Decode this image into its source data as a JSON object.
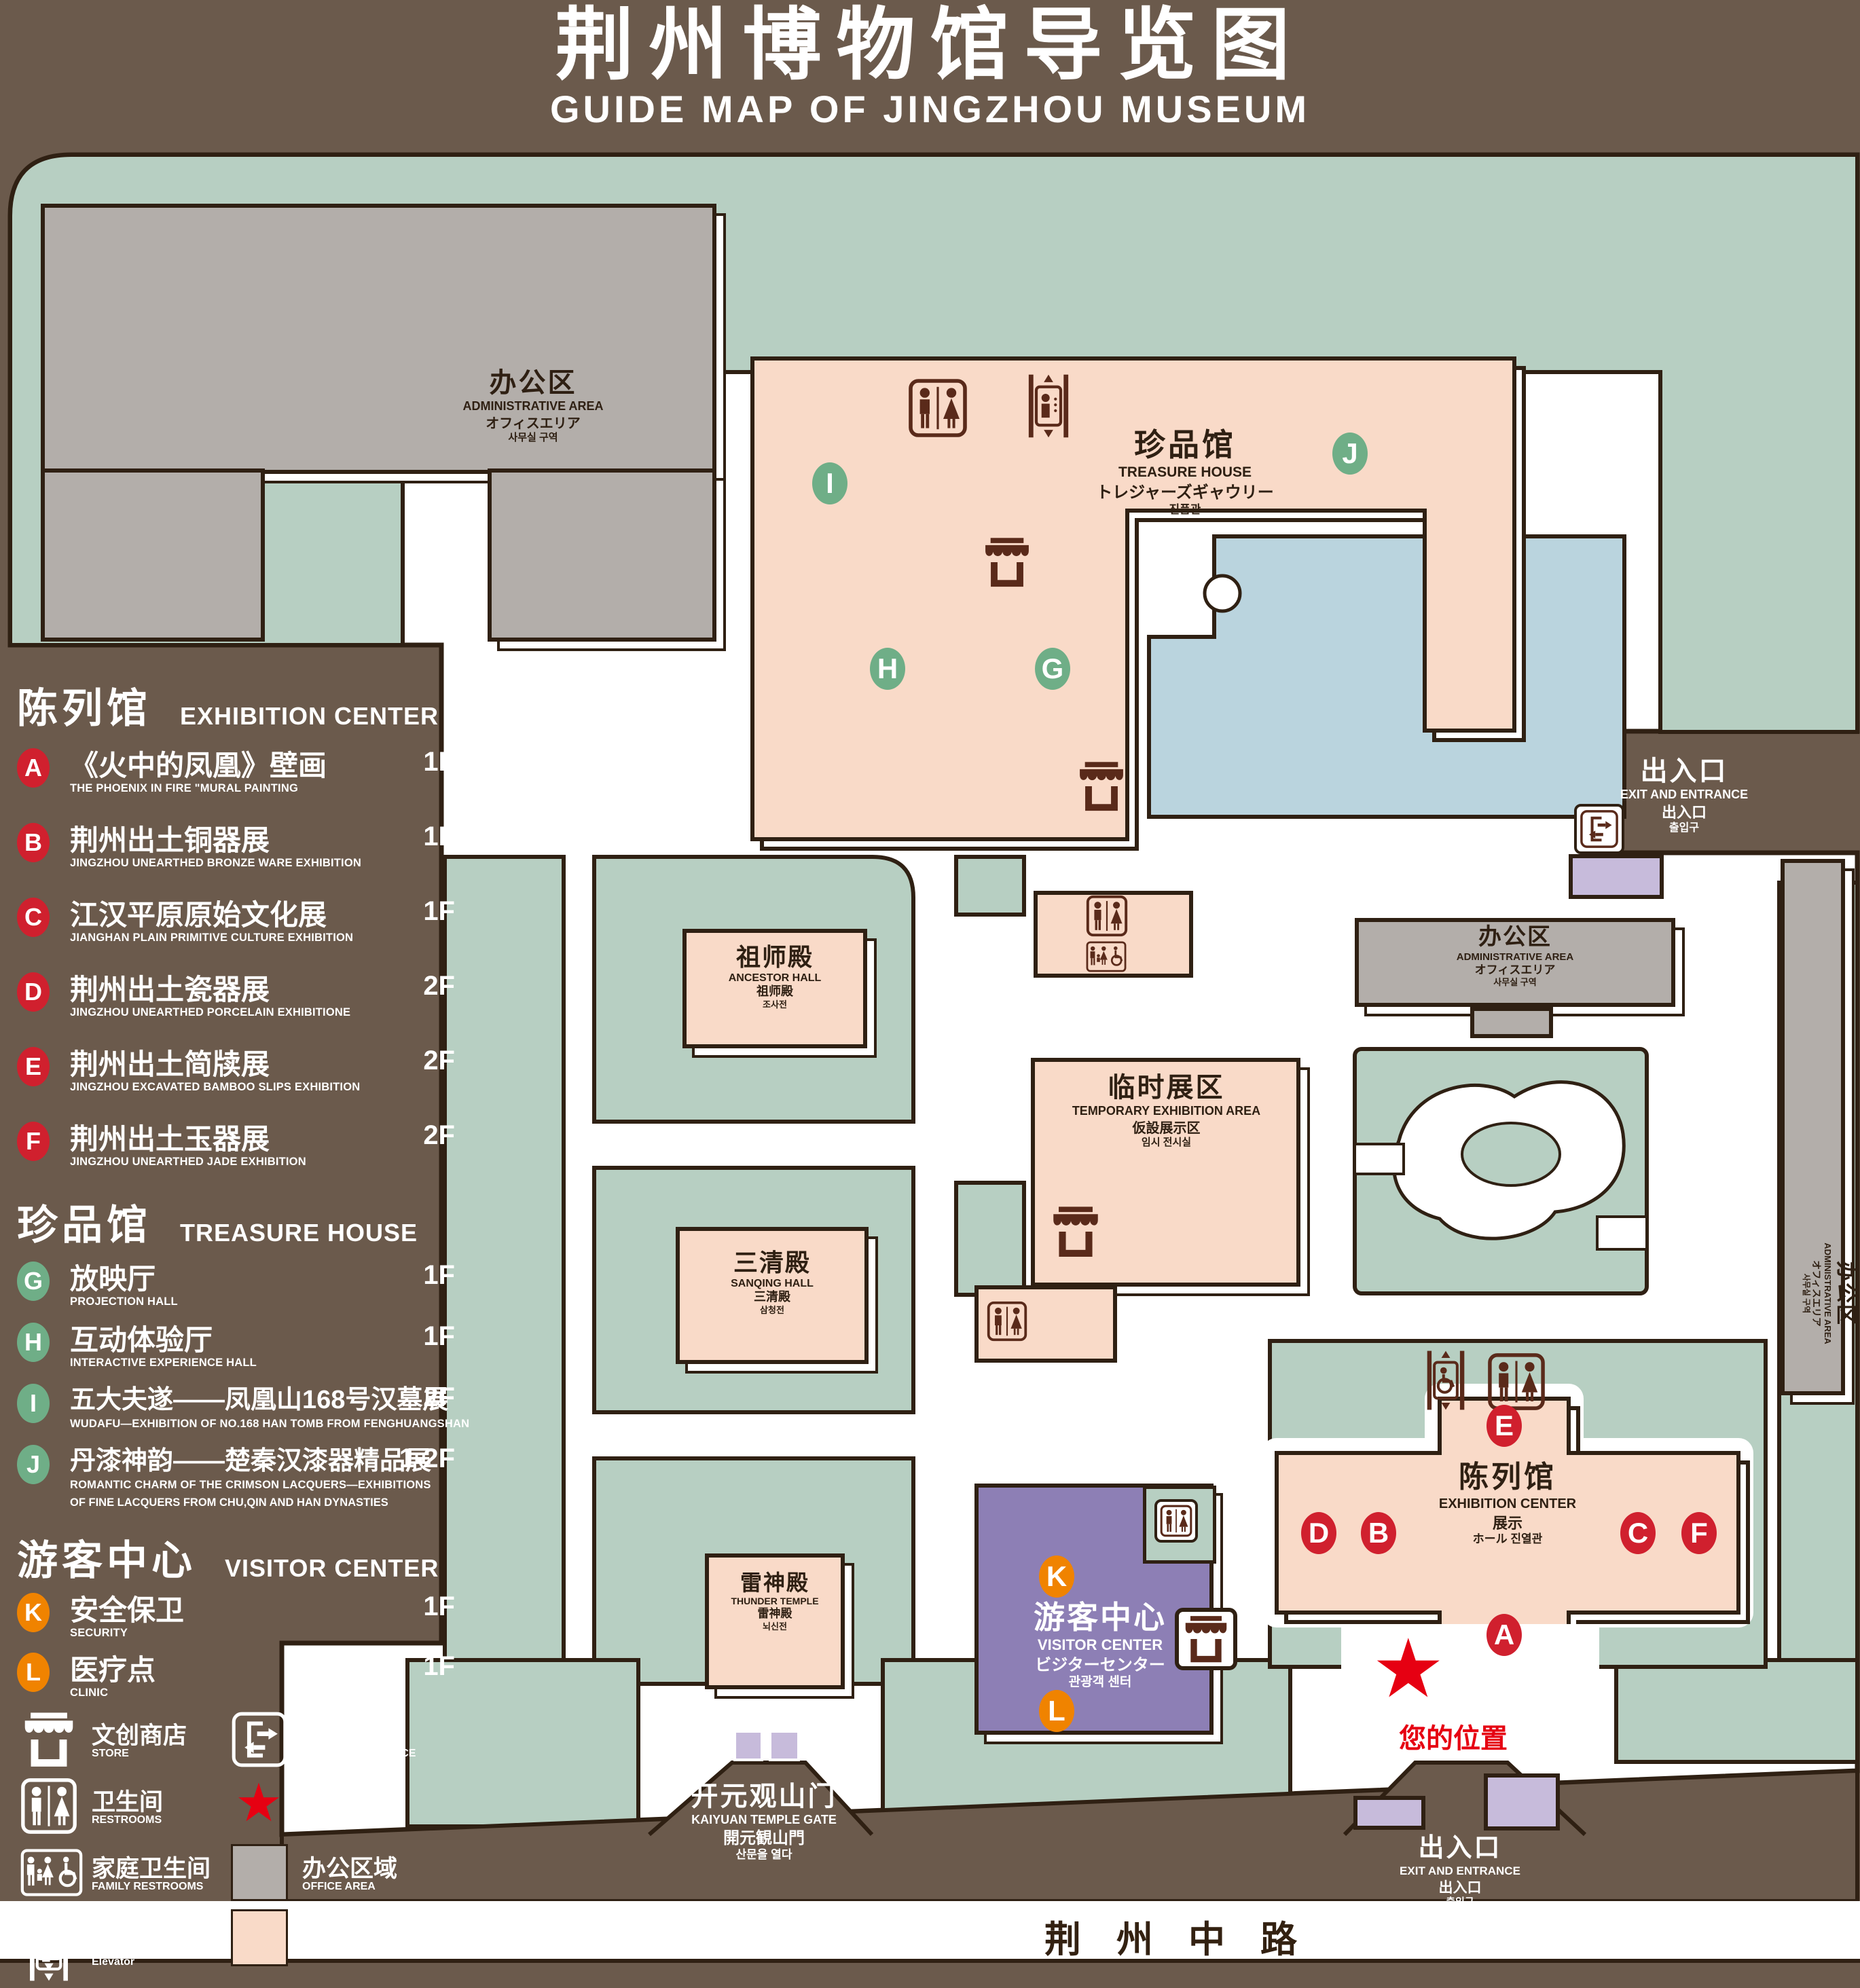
{
  "title": {
    "zh": "荆州博物馆导览图",
    "en": "GUIDE MAP OF JINGZHOU MUSEUM"
  },
  "star": "★",
  "legend": {
    "sections": [
      {
        "zh": "陈列馆",
        "en": "EXHIBITION CENTER",
        "items": [
          {
            "letter": "A",
            "zh": "《火中的凤凰》壁画",
            "en": "THE PHOENIX IN FIRE \"MURAL PAINTING",
            "floor": "1F"
          },
          {
            "letter": "B",
            "zh": "荆州出土铜器展",
            "en": "JINGZHOU UNEARTHED BRONZE WARE EXHIBITION",
            "floor": "1F"
          },
          {
            "letter": "C",
            "zh": "江汉平原原始文化展",
            "en": "JIANGHAN PLAIN PRIMITIVE CULTURE EXHIBITION",
            "floor": "1F"
          },
          {
            "letter": "D",
            "zh": "荆州出土瓷器展",
            "en": "JINGZHOU UNEARTHED PORCELAIN EXHIBITIONE",
            "floor": "2F"
          },
          {
            "letter": "E",
            "zh": "荆州出土简牍展",
            "en": "JINGZHOU EXCAVATED BAMBOO SLIPS EXHIBITION",
            "floor": "2F"
          },
          {
            "letter": "F",
            "zh": "荆州出土玉器展",
            "en": "JINGZHOU UNEARTHED JADE EXHIBITION",
            "floor": "2F"
          }
        ]
      },
      {
        "zh": "珍品馆",
        "en": "TREASURE HOUSE",
        "items": [
          {
            "letter": "G",
            "zh": "放映厅",
            "en": "PROJECTION HALL",
            "floor": "1F"
          },
          {
            "letter": "H",
            "zh": "互动体验厅",
            "en": "INTERACTIVE EXPERIENCE HALL",
            "floor": "1F"
          },
          {
            "letter": "I",
            "zh": "五大夫遂——凤凰山168号汉墓展",
            "en": "WUDAFU—EXHIBITION OF NO.168 HAN TOMB FROM FENGHUANGSHAN",
            "floor": "2F"
          },
          {
            "letter": "J",
            "zh": "丹漆神韵——楚秦汉漆器精品展",
            "en": "ROMANTIC CHARM OF THE CRIMSON LACQUERS—EXHIBITIONS",
            "en2": "OF FINE LACQUERS FROM CHU,QIN AND HAN DYNASTIES",
            "floor": "1-2F"
          }
        ]
      },
      {
        "zh": "游客中心",
        "en": "VISITOR CENTER",
        "items": [
          {
            "letter": "K",
            "zh": "安全保卫",
            "en": "SECURITY",
            "floor": "1F"
          },
          {
            "letter": "L",
            "zh": "医疗点",
            "en": "CLINIC",
            "floor": "1F"
          }
        ]
      }
    ],
    "facilities": {
      "col1": [
        {
          "zh": "文创商店",
          "en": "STORE"
        },
        {
          "zh": "卫生间",
          "en": "RESTROOMS"
        },
        {
          "zh": "家庭卫生间",
          "en": "FAMILY RESTROOMS"
        },
        {
          "zh": "无障碍电梯",
          "en": "ACCESSIBLE ELEVATOR"
        },
        {
          "zh": "电梯",
          "en": "Elevator"
        }
      ],
      "col2": [
        {
          "zh": "出入口",
          "en": "EXIT AND ENTRANCE"
        },
        {
          "zh": "您的位置",
          "en": "YOUR LOCATION"
        },
        {
          "zh": "办公区域",
          "en": "OFFICE AREA"
        },
        {
          "zh": "展示区域",
          "en": "DISPLAY AREA"
        }
      ]
    }
  },
  "map": {
    "markers": [
      "A",
      "B",
      "C",
      "D",
      "E",
      "F",
      "G",
      "H",
      "I",
      "J",
      "K",
      "L"
    ],
    "road": "荆州中路",
    "your_location": "您的位置",
    "buildings": {
      "admin_tl": {
        "zh": "办公区",
        "en": "ADMINISTRATIVE AREA",
        "jp": "オフィスエリア",
        "kr": "사무실 구역"
      },
      "treasure": {
        "zh": "珍品馆",
        "en": "TREASURE HOUSE",
        "jp": "トレジャーズギャウリー",
        "kr": "진품관"
      },
      "ancestor": {
        "zh": "祖师殿",
        "en": "ANCESTOR HALL",
        "jp": "祖师殿",
        "kr": "조사전"
      },
      "temporary": {
        "zh": "临时展区",
        "en": "TEMPORARY EXHIBITION AREA",
        "jp": "仮設展示区",
        "kr": "임시 전시실"
      },
      "sanqing": {
        "zh": "三清殿",
        "en": "SANQING HALL",
        "jp": "三清殿",
        "kr": "삼청전"
      },
      "thunder": {
        "zh": "雷神殿",
        "en": "THUNDER TEMPLE",
        "jp": "雷神殿",
        "kr": "뇌신전"
      },
      "visitor": {
        "zh": "游客中心",
        "en": "VISITOR CENTER",
        "jp": "ビジターセンター",
        "kr": "관광객 센터"
      },
      "exhibition": {
        "zh": "陈列馆",
        "en": "EXHIBITION CENTER",
        "jp": "展示",
        "kr": "ホール 진열관"
      },
      "admin_mr": {
        "zh": "办公区",
        "en": "ADMINISTRATIVE AREA",
        "jp": "オフィスエリア",
        "kr": "사무실 구역"
      },
      "admin_fr": {
        "zh": "办公区",
        "en": "ADMINISTRATIVE AREA",
        "jp": "オフィスエリア",
        "kr": "사무실 구역"
      },
      "gate": {
        "zh": "开元观山门",
        "en": "KAIYUAN TEMPLE GATE",
        "jp": "開元観山門",
        "kr": "산문을 열다"
      },
      "exit_top": {
        "zh": "出入口",
        "en": "EXIT AND ENTRANCE",
        "jp": "出入口",
        "kr": "출입구"
      },
      "exit_bottom": {
        "zh": "出入口",
        "en": "EXIT AND ENTRANCE",
        "jp": "出入口",
        "kr": "출입구"
      }
    }
  },
  "colors": {
    "background": "#6b5a4c",
    "green": "#b7cfc2",
    "display_area": "#f9dac8",
    "office_area": "#b3aeaa",
    "water": "#bad4de",
    "visitor_purple": "#8d7fb5",
    "light_purple": "#c7bbdb",
    "marker_red": "#d0202e",
    "marker_green": "#6fae87",
    "marker_orange": "#f08300",
    "location_red": "#e60012",
    "outline": "#2f2013"
  }
}
